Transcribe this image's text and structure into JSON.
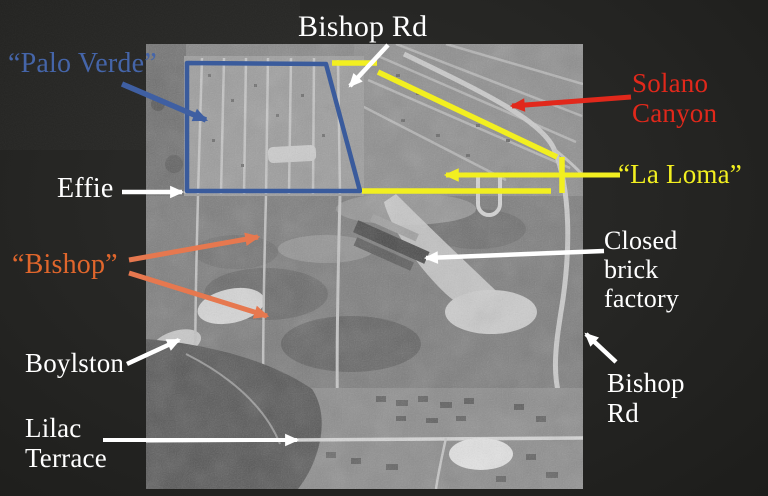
{
  "slide": {
    "labels": {
      "bishop_rd_top": "Bishop Rd",
      "palo_verde": "“Palo Verde”",
      "solano_canyon": "Solano Canyon",
      "la_loma": "“La Loma”",
      "effie": "Effie",
      "bishop": "“Bishop”",
      "closed_brick_factory": "Closed brick factory",
      "boylston": "Boylston",
      "bishop_rd_right": "Bishop Rd",
      "lilac_terrace": "Lilac Terrace"
    },
    "annotation_colors": {
      "white_labels_and_arrows": "#ffffff",
      "palo_verde_blue": "#3f5fa2",
      "solano_canyon_red": "#e1281b",
      "la_loma_yellow": "#f2ef20",
      "bishop_orange_text": "#e0662c",
      "bishop_orange_arrows": "#e6784f",
      "slide_background": "#252523"
    }
  }
}
